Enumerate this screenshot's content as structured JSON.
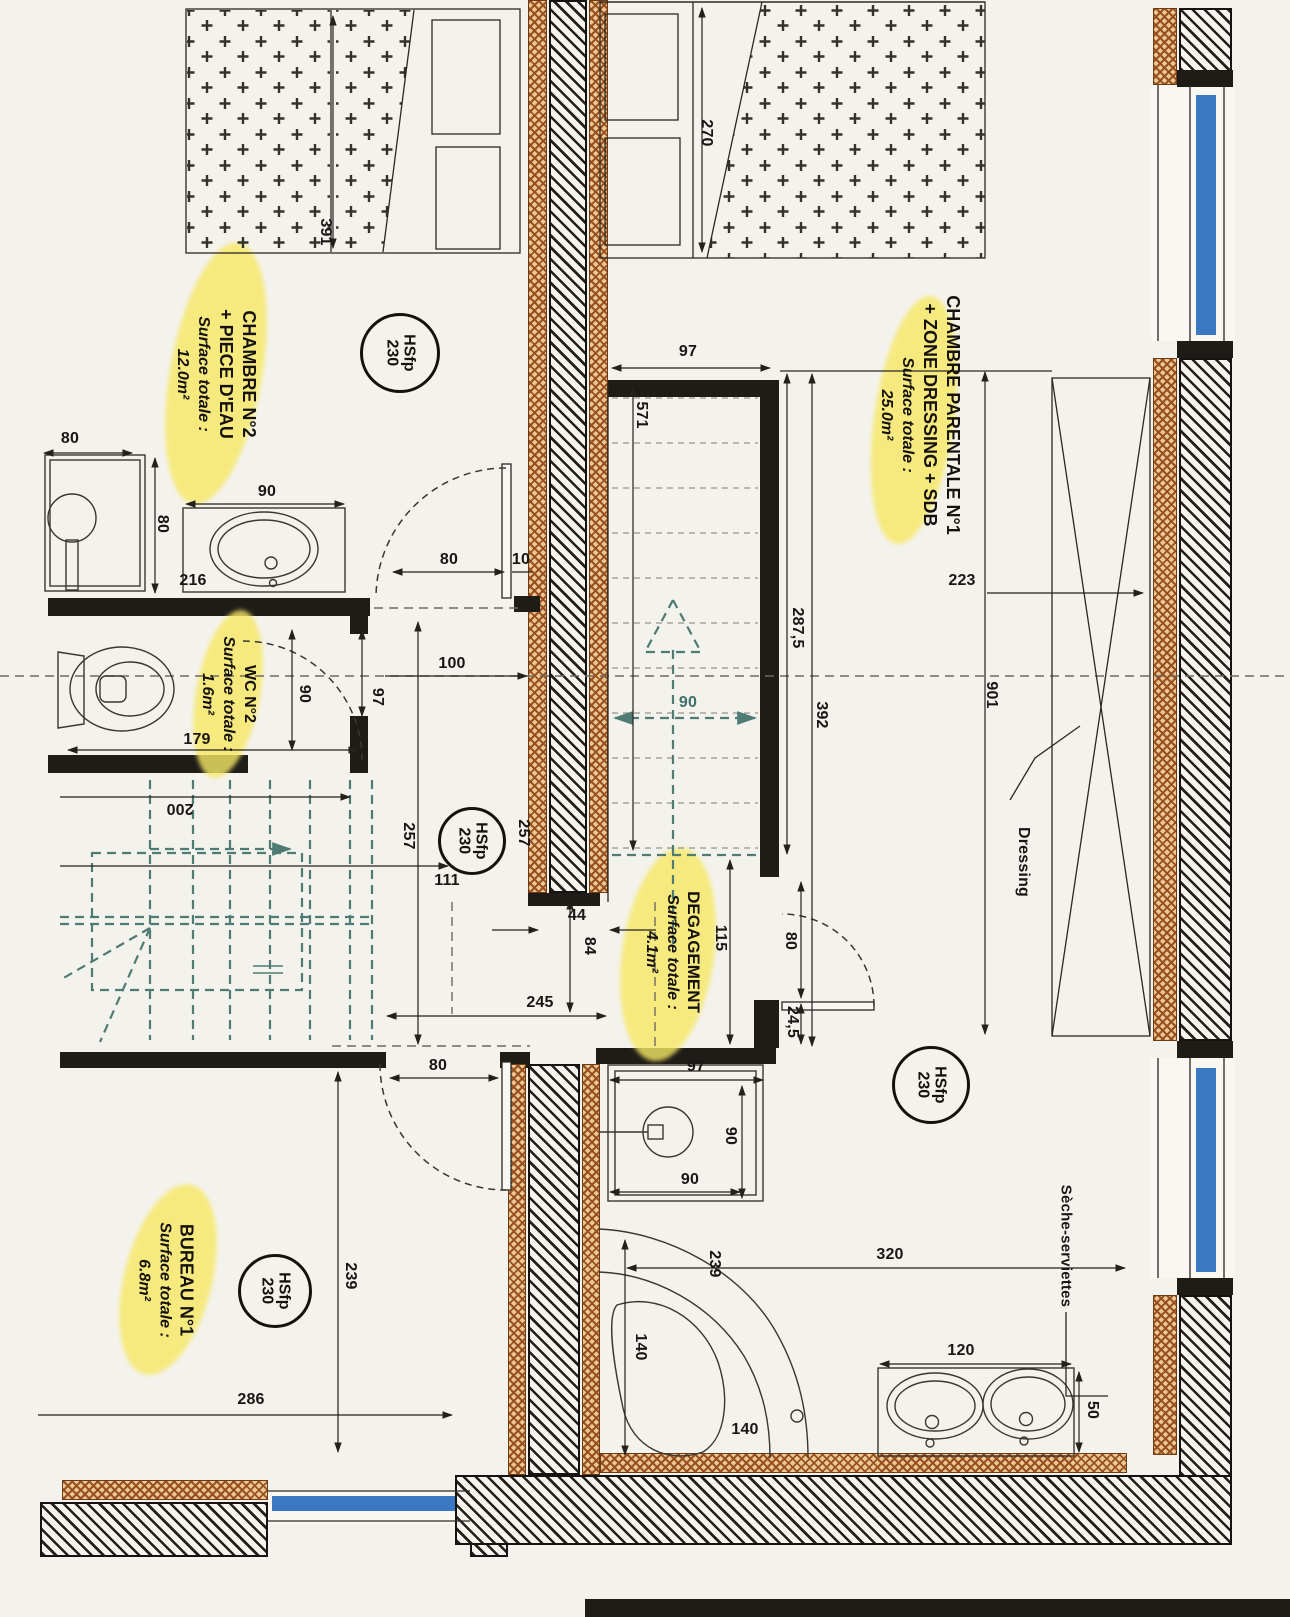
{
  "rooms": [
    {
      "name": "CHAMBRE N°2",
      "name2": "+ PIECE D'EAU",
      "surface_label": "Surface totale :",
      "surface": "12.0m²"
    },
    {
      "name": "WC N°2",
      "name2": "",
      "surface_label": "Surface totale :",
      "surface": "1.6m²"
    },
    {
      "name": "CHAMBRE PARENTALE N°1",
      "name2": "+ ZONE DRESSING + SDB",
      "surface_label": "Surface totale :",
      "surface": "25.0m²"
    },
    {
      "name": "DEGAGEMENT",
      "name2": "",
      "surface_label": "Surface totale :",
      "surface": "4.1m²"
    },
    {
      "name": "BUREAU N°1",
      "name2": "",
      "surface_label": "Surface totale :",
      "surface": "6.8m²"
    }
  ],
  "height_marker": {
    "abbr": "HSfp",
    "value": "230"
  },
  "annotations": {
    "dressing": "Dressing",
    "towel_dryer": "Sèche-serviettes"
  },
  "dims": {
    "d391": "391",
    "d270": "270",
    "d97_stair": "97",
    "d571": "571",
    "d287": "287,5",
    "d392": "392",
    "d901": "901",
    "d223": "223",
    "d80_shower": "80",
    "d80_shower_v": "80",
    "d90_sink": "90",
    "d216": "216",
    "d80_door": "80",
    "d10_door": "10",
    "d90_wc": "90",
    "d100": "100",
    "d97_wc": "97",
    "d179": "179",
    "d200": "200",
    "d257a": "257",
    "d257b": "257",
    "d111": "111",
    "d44": "44",
    "d84": "84",
    "d245": "245",
    "d115": "115",
    "d80_deg": "80",
    "d24": "24,5",
    "d90_stair": "90",
    "d97_shower": "97",
    "d90_shower_v": "90",
    "d90_shower_b": "90",
    "d239_tub": "239",
    "d140_tub": "140",
    "d140_tub_b": "140",
    "d320": "320",
    "d120": "120",
    "d50": "50",
    "d286": "286",
    "d239_bureau": "239",
    "d80_bureau": "80"
  },
  "colors": {
    "paper": "#f4f2ec",
    "wall": "#1f1c18",
    "insulation": "#9c5a26",
    "window": "#3a79c2",
    "stair_teal": "#4e7b74",
    "highlight": "#f6e96b"
  }
}
